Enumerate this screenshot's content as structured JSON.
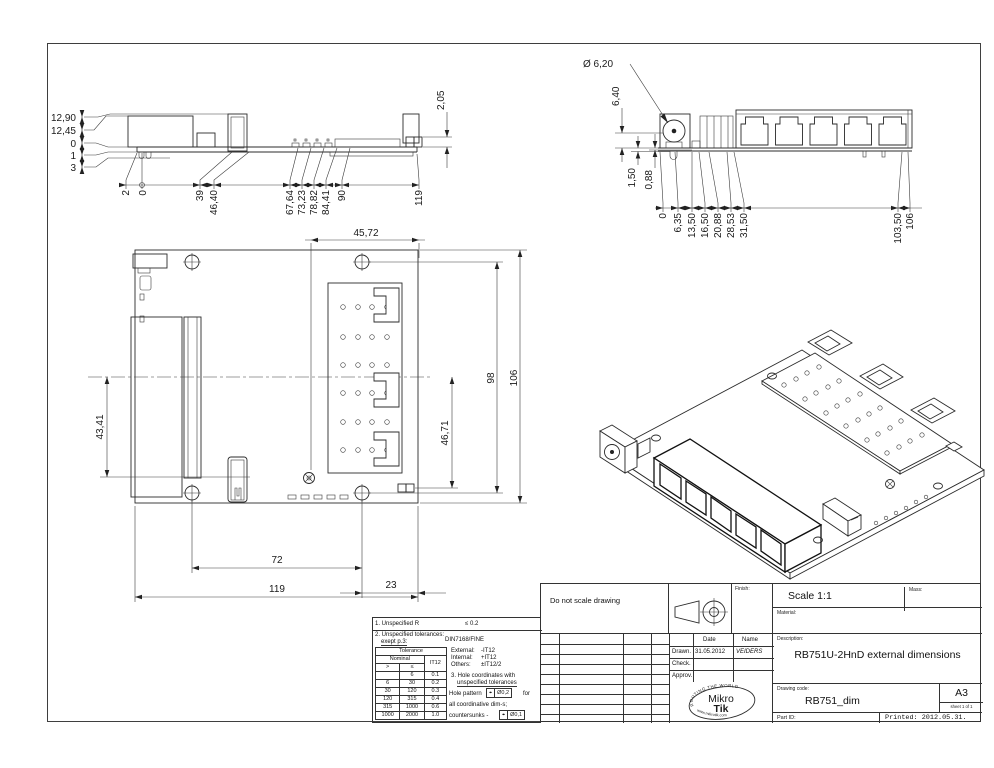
{
  "views": {
    "side": {
      "heights": [
        "12,90",
        "12,45",
        "0",
        "1",
        "3"
      ],
      "widths": [
        "2",
        "0",
        "39",
        "46,40",
        "67,64",
        "73,23",
        "78,82",
        "84,41",
        "90",
        "119"
      ],
      "conn": "2,05"
    },
    "front": {
      "dia": "Ø 6,20",
      "heights": [
        "6,40",
        "1,50",
        "0,88"
      ],
      "widths": [
        "0",
        "6,35",
        "13,50",
        "16,50",
        "20,88",
        "28,53",
        "31,50",
        "103,50",
        "106"
      ]
    },
    "top": {
      "top_w": "45,72",
      "h98": "98",
      "h106": "106",
      "left_h": "43,41",
      "right_h": "46,71",
      "w72": "72",
      "w119": "119",
      "w23": "23"
    }
  },
  "notes": {
    "n1": "1. Unspecified R",
    "n1_value": "≤  0.2",
    "n2": "2. Unspecified tolerances:",
    "n2b": "exept p.3:",
    "n2_value": "DIN7168/FINE",
    "external": "External:",
    "external_v": "-IT12",
    "internal": "Internal:",
    "internal_v": "+IT12",
    "others": "Others:",
    "others_v": "±IT12/2",
    "n3a": "3. Hole coordinates with",
    "n3b": "unspecified tolerances",
    "hole_pattern": "Hole pattern",
    "pos_symbol": "⌖",
    "hole_tol": "Ø0,2",
    "for_suffix": "for",
    "coordinative": "all coordinative dim-s;",
    "countersunks": "countersunks -",
    "cs_symbol": "⌖",
    "cs_tol": "Ø0,1"
  },
  "tol_table": {
    "title": "Tolerance",
    "nominal": "Nominal",
    "it12": "IT12",
    "gt": ">",
    "lte": "≤",
    "rows": [
      [
        "",
        "6",
        "0.1"
      ],
      [
        "6",
        "30",
        "0.2"
      ],
      [
        "30",
        "120",
        "0.3"
      ],
      [
        "120",
        "315",
        "0.4"
      ],
      [
        "315",
        "1000",
        "0.6"
      ],
      [
        "1000",
        "2000",
        "1.0"
      ]
    ]
  },
  "title_block": {
    "do_not_scale": "Do not scale drawing",
    "finish": "Finish:",
    "scale": "Scale  1:1",
    "mass": "Mass:",
    "material": "Material:",
    "description_label": "Description:",
    "description": "RB751U-2HnD external dimensions",
    "date": "Date",
    "name": "Name",
    "drawn": "Drawn.",
    "drawn_date": "31.05.2012",
    "drawn_name": "VEIDERS",
    "check": "Check.",
    "approv": "Approv.",
    "drawing_code_label": "Drawing code:",
    "drawing_code": "RB751_dim",
    "format": "A3",
    "sheet": "sheet 1 of 1",
    "part_id": "Part ID:",
    "printed": "Printed: 2012.05.31.",
    "logo_arc_top": "ROUTING THE WORLD",
    "logo_mikro": "Mikro",
    "logo_tik": "Tik",
    "logo_arc_bottom": "www.mikrotik.com"
  }
}
